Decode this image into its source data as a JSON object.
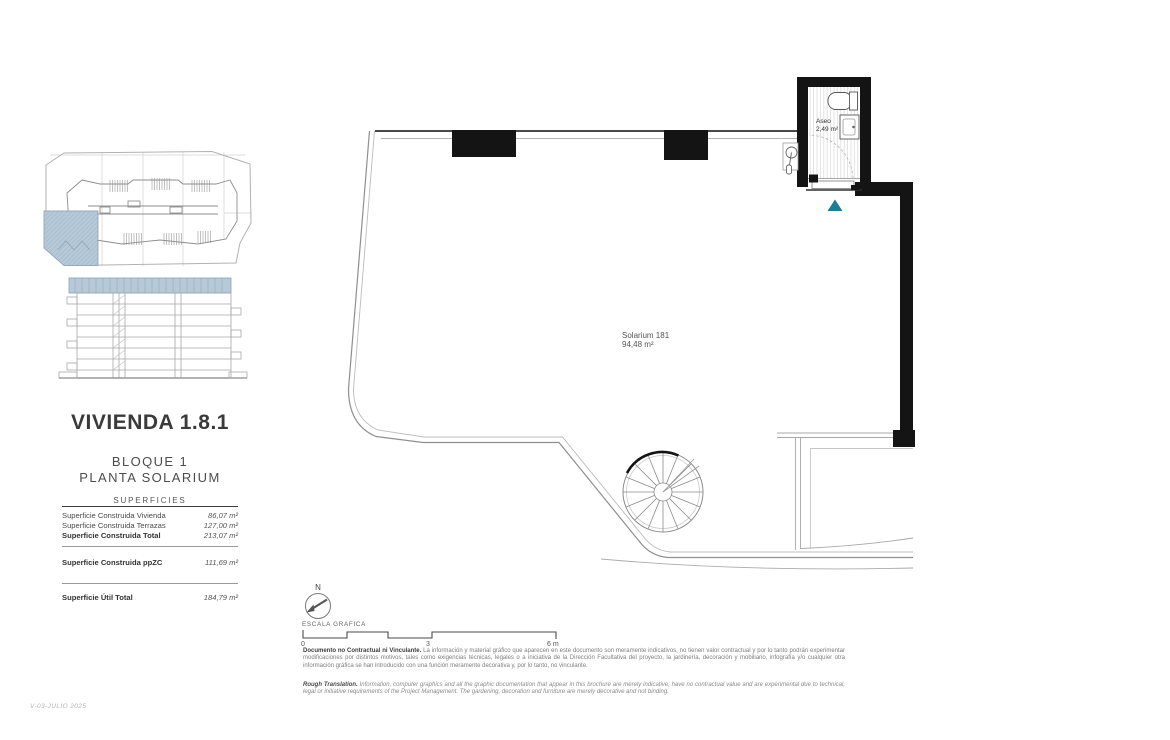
{
  "sidebar": {
    "title": "VIVIENDA 1.8.1",
    "subtitle_line1": "BLOQUE 1",
    "subtitle_line2": "PLANTA SOLARIUM",
    "surfaces": {
      "heading": "SUPERFICIES",
      "rows": [
        {
          "label": "Superficie Construida Vivienda",
          "value": "86,07 m²"
        },
        {
          "label": "Superficie Construida Terrazas",
          "value": "127,00 m²"
        },
        {
          "label": "Superficie Construida Total",
          "value": "213,07 m²"
        },
        {
          "label": "Superficie Construida ppZC",
          "value": "111,69 m²"
        },
        {
          "label": "Superficie Útil Total",
          "value": "184,79 m²"
        }
      ]
    },
    "version": "V-03-JULIO 2025"
  },
  "plan": {
    "room_label": "Solarium 181",
    "room_area": "94,48 m²",
    "bathroom_label": "Aseo",
    "bathroom_area": "2,49 m²"
  },
  "legend": {
    "north_label": "N",
    "scale_label": "ESCALA GRAFICA",
    "scale_ticks": [
      "0",
      "3",
      "6 m"
    ]
  },
  "footer": {
    "disclaimer_es_title": "Documento no Contractual ni Vinculante.",
    "disclaimer_es_body": "La información y material gráfico que aparecen en este documento son meramente indicativos, no tienen valor contractual y por lo tanto podrán experimentar modificaciones por distintos motivos, tales como exigencias técnicas, legales o a iniciativa de la Dirección Facultativa del proyecto, la jardinería, decoración y mobiliario, infografía y/o cualquier otra información gráfica se han introducido con una función meramente decorativa y, por lo tanto, no vinculante.",
    "disclaimer_en_title": "Rough Translation.",
    "disclaimer_en_body": "Information, computer graphics and all the graphic documentation that appear in this brochure are merely indicative, have no contractual value and are experimental due to technical, legal or initiative requirements of the Project Management. The gardening, decoration and furniture are merely decorative and not binding."
  },
  "colors": {
    "highlight_blue": "#b7c9d8",
    "entrance_marker_teal": "#1d7e93",
    "wall_black": "#141414"
  }
}
